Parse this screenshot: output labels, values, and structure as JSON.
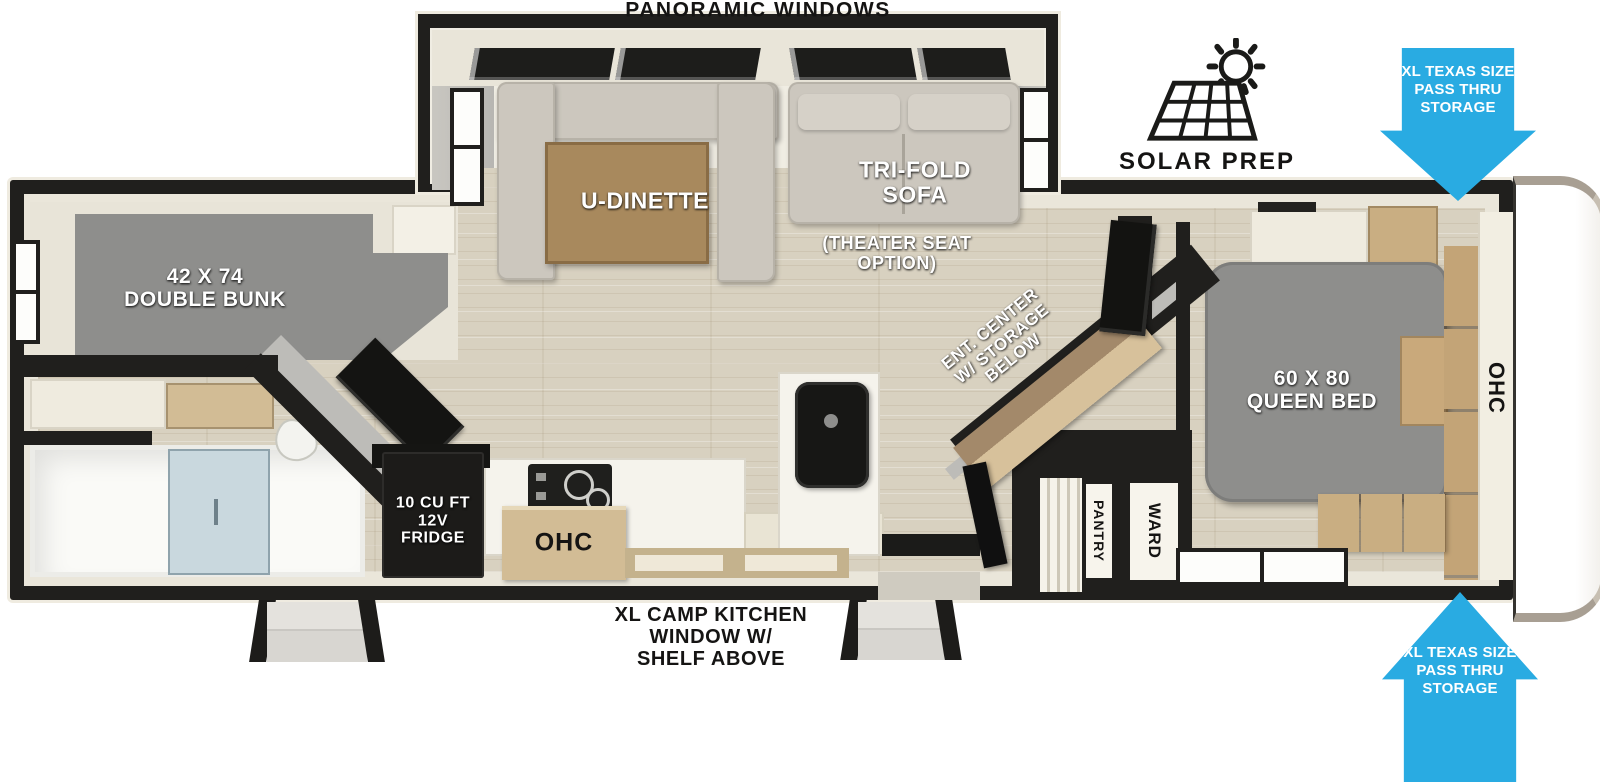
{
  "annotations": {
    "panoramic_windows": "PANORAMIC WINDOWS",
    "solar_prep": "SOLAR PREP",
    "camp_kitchen_l1": "XL CAMP KITCHEN",
    "camp_kitchen_l2": "WINDOW W/",
    "camp_kitchen_l3": "SHELF ABOVE",
    "pass_thru_l1": "XL TEXAS SIZE",
    "pass_thru_l2": "PASS THRU",
    "pass_thru_l3": "STORAGE"
  },
  "labels": {
    "dinette": "U-DINETTE",
    "sofa_l1": "TRI-FOLD",
    "sofa_l2": "SOFA",
    "sofa_opt_l1": "(THEATER SEAT",
    "sofa_opt_l2": "OPTION)",
    "bunk_l1": "42 X 74",
    "bunk_l2": "DOUBLE BUNK",
    "queen_l1": "60 X 80",
    "queen_l2": "QUEEN BED",
    "ent_l1": "ENT. CENTER",
    "ent_l2": "W/ STORAGE",
    "ent_l3": "BELOW",
    "fridge_l1": "10 CU FT",
    "fridge_l2": "12V",
    "fridge_l3": "FRIDGE",
    "ohc_kitchen": "OHC",
    "ohc_bedroom": "OHC",
    "pantry": "PANTRY",
    "ward": "WARD"
  },
  "colors": {
    "arrow_blue": "#29ABE2",
    "wall_black": "#201F1D",
    "lining_cream": "#EAE6DA",
    "floor_wood": "#D8D1C0",
    "mattress_gray": "#8E8E8C",
    "cabinet_tan": "#D2BC95",
    "wood_dark": "#A8895D",
    "sofa_beige": "#CCC7BE",
    "shower_glass": "#C9D8DE"
  }
}
